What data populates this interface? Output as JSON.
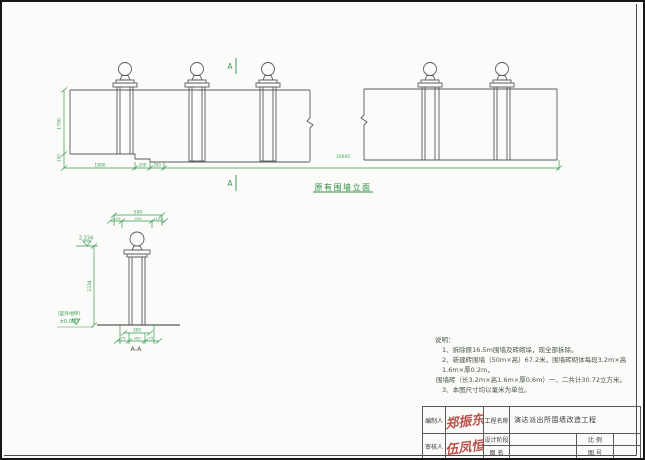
{
  "drawing": {
    "elevation": {
      "section_marker_top": "A",
      "section_marker_bottom": "A",
      "caption": "原有围墙立面",
      "dim_height": "1700",
      "dim_step": "150",
      "dims_bottom": [
        "1800",
        "200",
        "350"
      ],
      "dim_total": "10045"
    },
    "detail": {
      "caption": "A-A",
      "dim_top": "500",
      "dims_top_sub": [
        "125",
        "250",
        "125"
      ],
      "level_top": "2.234",
      "dim_height": "2234",
      "ground_note": "（室外地坪）",
      "level_ground": "±0.000",
      "dim_base_upper": "300",
      "dims_base": [
        "75",
        "300",
        "75"
      ]
    },
    "notes": {
      "title": "说明：",
      "lines": [
        "1、拆除原16.5m围墙及砖砌垛，现全部拆除。",
        "2、新建砖围墙（50m×高）67.2米，围墙砖砌体每段3.2m×高1.6m×厚0.2m，",
        "围墙砖（长3.2m×高1.6m×厚0.6m）一、二共计30.72立方米。",
        "3、本图尺寸均以毫米为单位。"
      ]
    },
    "titleblock": {
      "preparer_label": "编制人",
      "preparer_signature": "郑振东",
      "reviewer_label": "审核人",
      "reviewer_signature": "伍凤恒",
      "project_label": "工程名称",
      "project_name": "演达派出所围墙改造工程",
      "stage_label": "设计阶段",
      "name_label": "图 名",
      "scale_label": "比 例",
      "number_label": "图 号"
    },
    "colors": {
      "line": "#5a5a5a",
      "dim_green": "#3a9a52",
      "caption_green": "#2e8b44",
      "signature_red": "#b23a32"
    }
  }
}
